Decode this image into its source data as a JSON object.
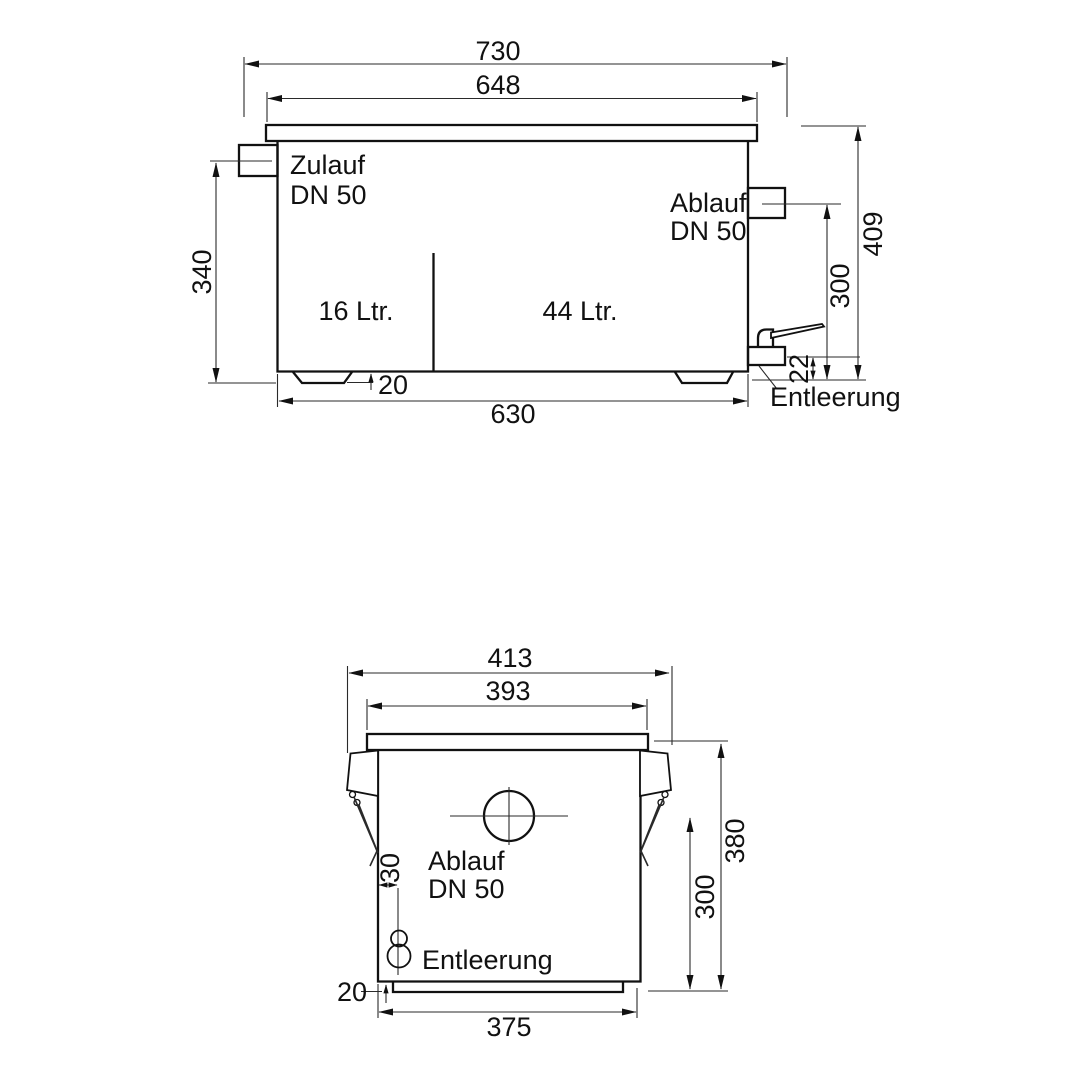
{
  "style": {
    "ink": "#111111",
    "background": "#ffffff"
  },
  "side_view": {
    "dim_overall_width": "730",
    "dim_lid_width": "648",
    "dim_inlet_height": "340",
    "dim_total_height": "409",
    "dim_outlet_height": "300",
    "dim_drain_height": "22",
    "dim_foot_height": "20",
    "dim_body_length": "630",
    "label_inlet_1": "Zulauf",
    "label_inlet_2": "DN 50",
    "label_outlet_1": "Ablauf",
    "label_outlet_2": "DN 50",
    "label_chamber_small": "16 Ltr.",
    "label_chamber_large": "44 Ltr.",
    "label_drain": "Entleerung"
  },
  "front_view": {
    "dim_overall_width": "413",
    "dim_lid_width": "393",
    "dim_total_height": "380",
    "dim_outlet_height": "300",
    "dim_drain_offset": "30",
    "dim_base_height": "20",
    "dim_base_width": "375",
    "label_outlet_1": "Ablauf",
    "label_outlet_2": "DN 50",
    "label_drain": "Entleerung"
  }
}
